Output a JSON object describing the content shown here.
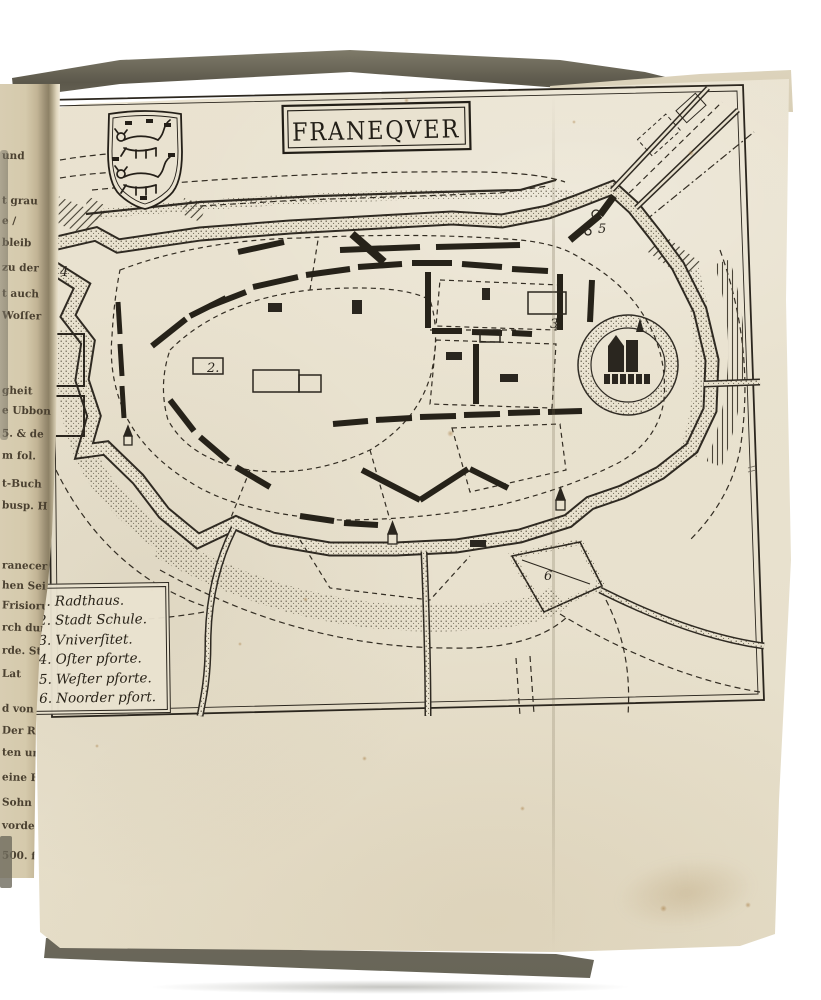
{
  "map": {
    "title": "FRANEQVER",
    "legend": {
      "items": [
        {
          "number": "1.",
          "label": "Radthaus."
        },
        {
          "number": "2.",
          "label": "Stadt Schule."
        },
        {
          "number": "3.",
          "label": "Vniverſitet."
        },
        {
          "number": "4.",
          "label": "Oſter pforte."
        },
        {
          "number": "5.",
          "label": "Weſter pforte."
        },
        {
          "number": "6.",
          "label": "Noorder pfort."
        }
      ]
    },
    "markers": [
      "2.",
      "3",
      "4",
      "5",
      "6"
    ]
  },
  "margin_fragments": [
    "und",
    "t grau",
    "e /",
    "bleib",
    "zu der",
    "t auch",
    "Woſſer",
    "gheit",
    "e Ubbon",
    "5. & de",
    "m fol.",
    "t-Buch",
    "busp. H",
    "ranecer",
    "hen Sei",
    "Frisioru",
    "rch dur",
    "rde. St",
    "Lat",
    "d von",
    "Der Ra",
    "ten und",
    "eine Hoff",
    "Sohn He",
    "vorden",
    "500. fl."
  ],
  "colors": {
    "paper": "#e8e1ce",
    "ink": "#2b261e",
    "book_edge": "#8e8a7c",
    "background": "#ffffff"
  }
}
